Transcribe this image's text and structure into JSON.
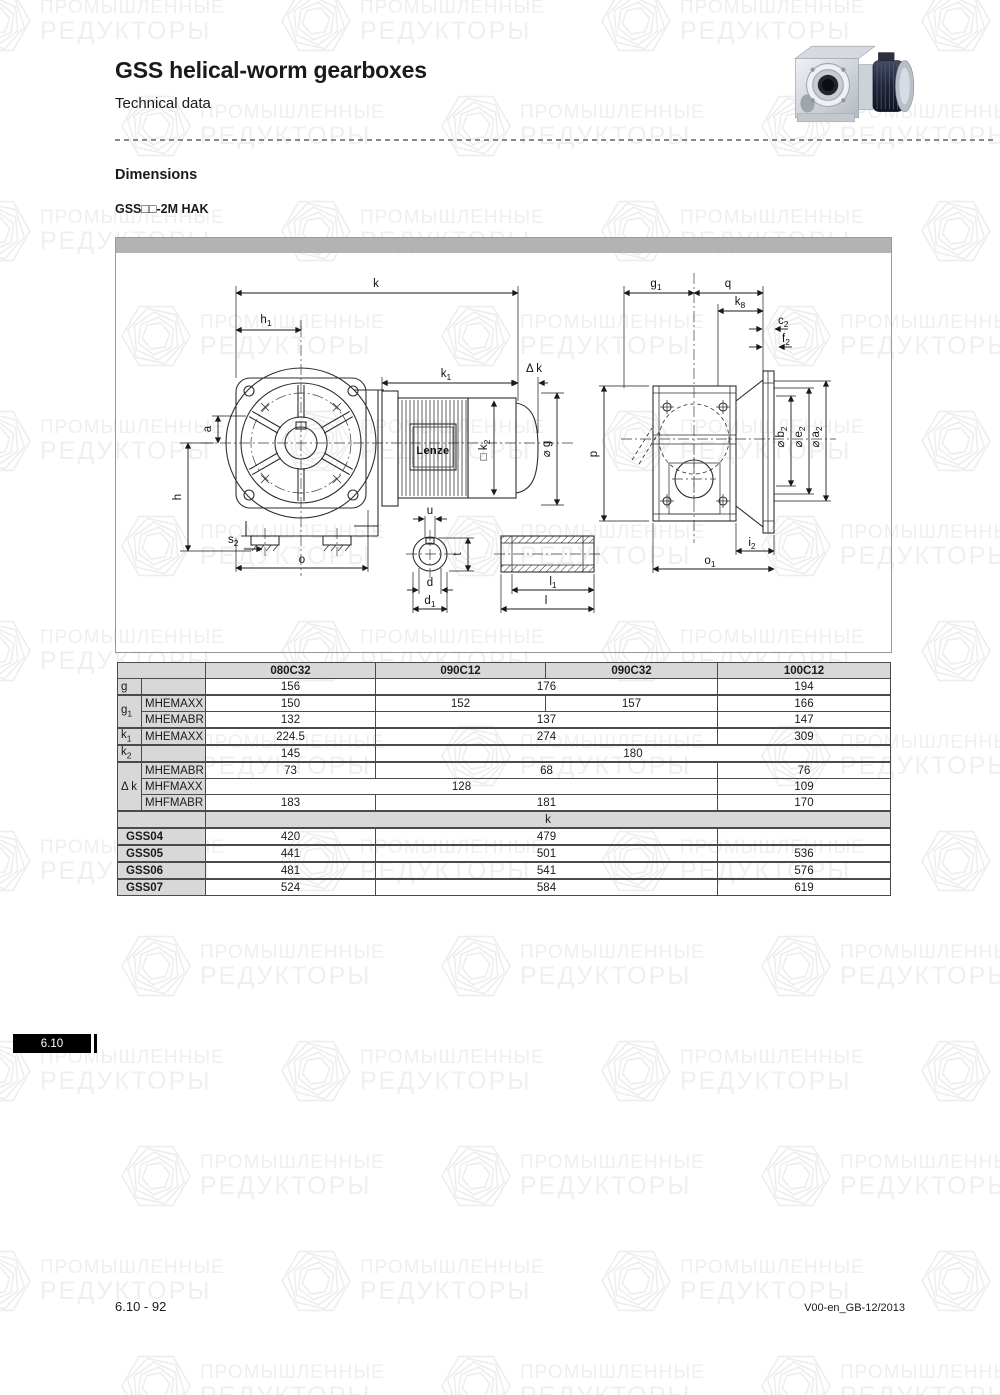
{
  "watermark": {
    "line1": "ПРОМЫШЛЕННЫЕ",
    "line2": "РЕДУКТОРЫ"
  },
  "header": {
    "title": "GSS helical-worm gearboxes",
    "subtitle": "Technical data"
  },
  "section": {
    "heading": "Dimensions",
    "model": "GSS□□-2M HAK"
  },
  "drawing": {
    "motor_brand": "Lenze",
    "labels": {
      "k": "k",
      "a": "a",
      "h": "h",
      "o": "o",
      "u": "u",
      "t": "t",
      "d": "d",
      "l": "l",
      "q": "q",
      "p": "p",
      "dk": "Δ k",
      "g": "⌀ g",
      "h1": {
        "b": "h",
        "s": "1"
      },
      "k1": {
        "b": "k",
        "s": "1"
      },
      "k2": {
        "b": "□ k",
        "s": "2"
      },
      "s2": {
        "b": "s",
        "s": "2"
      },
      "d1": {
        "b": "d",
        "s": "1"
      },
      "l1": {
        "b": "l",
        "s": "1"
      },
      "g1": {
        "b": "g",
        "s": "1"
      },
      "k8": {
        "b": "k",
        "s": "8"
      },
      "c2": {
        "b": "c",
        "s": "2"
      },
      "f2": {
        "b": "f",
        "s": "2"
      },
      "b2": {
        "b": "⌀ b",
        "s": "2"
      },
      "e2": {
        "b": "⌀ e",
        "s": "2"
      },
      "a2": {
        "b": "⌀ a",
        "s": "2"
      },
      "i2": {
        "b": "i",
        "s": "2"
      },
      "o1": {
        "b": "o",
        "s": "1"
      }
    }
  },
  "table": {
    "col_headers": [
      "080C32",
      "090C12",
      "090C32",
      "100C12"
    ],
    "rows": {
      "g": {
        "label": "g",
        "v1": "156",
        "v23": "176",
        "v4": "194"
      },
      "g1": {
        "base": "g",
        "sub": "1",
        "maxx": {
          "label": "MHEMAXX",
          "v1": "150",
          "v2": "152",
          "v3": "157",
          "v4": "166"
        },
        "mabr": {
          "label": "MHEMABR",
          "v1": "132",
          "v23": "137",
          "v4": "147"
        }
      },
      "k1": {
        "base": "k",
        "sub": "1",
        "maxx": {
          "label": "MHEMAXX",
          "v1": "224.5",
          "v23": "274",
          "v4": "309"
        }
      },
      "k2": {
        "base": "k",
        "sub": "2",
        "v1": "145",
        "v234": "180"
      },
      "dk": {
        "label": "Δ k",
        "mhemabr": {
          "label": "MHEMABR",
          "v1": "73",
          "v23": "68",
          "v4": "76"
        },
        "mhfmaxx": {
          "label": "MHFMAXX",
          "v123": "128",
          "v4": "109"
        },
        "mhfmabr": {
          "label": "MHFMABR",
          "v1": "183",
          "v23": "181",
          "v4": "170"
        }
      },
      "kband": {
        "label": "k"
      },
      "gss": [
        {
          "label": "GSS04",
          "v1": "420",
          "v23": "479",
          "v4": ""
        },
        {
          "label": "GSS05",
          "v1": "441",
          "v23": "501",
          "v4": "536"
        },
        {
          "label": "GSS06",
          "v1": "481",
          "v23": "541",
          "v4": "576"
        },
        {
          "label": "GSS07",
          "v1": "524",
          "v23": "584",
          "v4": "619"
        }
      ]
    }
  },
  "tab": {
    "label": "6.10"
  },
  "footer": {
    "left": "6.10 - 92",
    "right": "V00-en_GB-12/2013"
  },
  "colors": {
    "table_header_bg": "#d8d8d8",
    "drawing_bar": "#b3b3b3",
    "tab_bg": "#000000"
  }
}
